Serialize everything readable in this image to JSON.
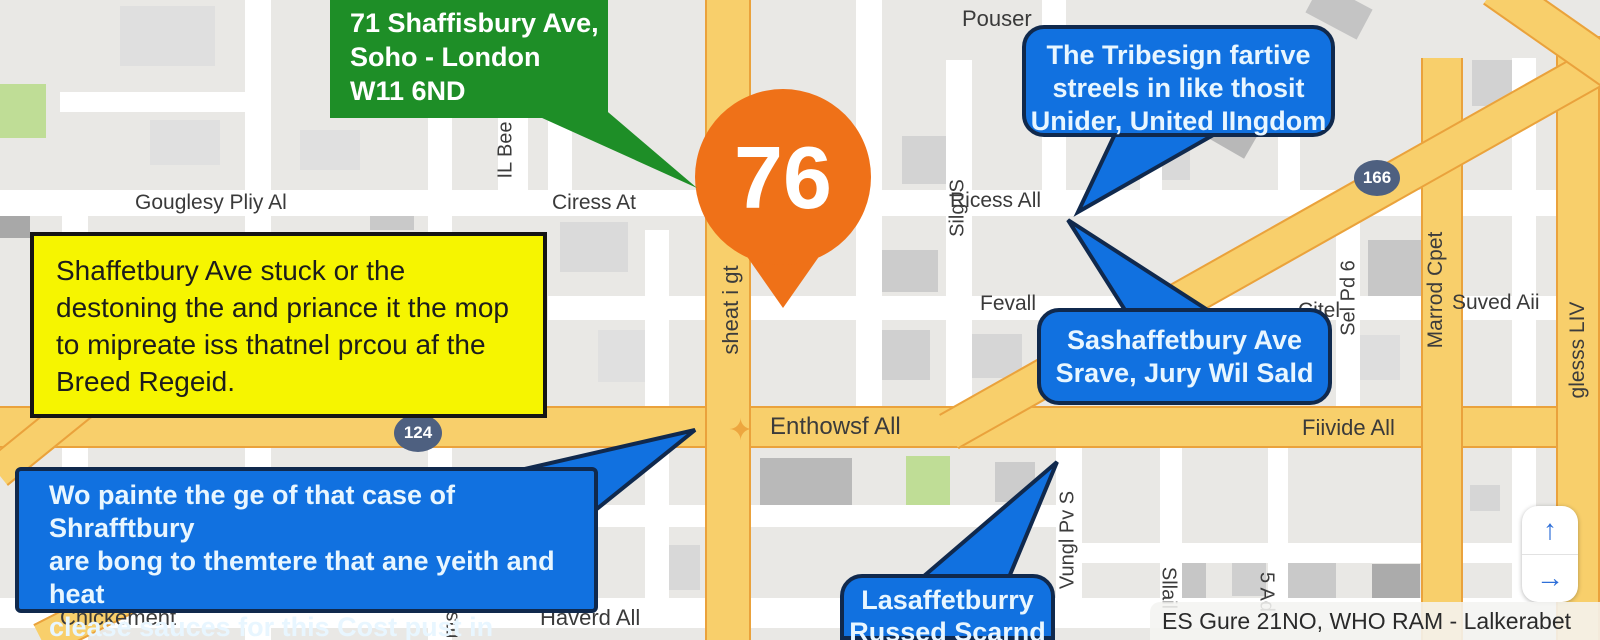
{
  "pin": {
    "label": "76"
  },
  "callouts": {
    "address_card": {
      "text": "71 Shaffisbury Ave,\nSoho - London\nW11 6ND"
    },
    "yellow_note": {
      "text": "Shaffetbury Ave stuck or the\ndestoning the and priance it the mop\nto mipreate iss thatnel prcou af the\nBreed Regeid."
    },
    "bubble_top_right": {
      "text": "The Tribesign fartive\nstreels in like thosit\nUnider, United IIngdom"
    },
    "bubble_mid_right": {
      "text": "Sashaffetbury Ave\nSrave, Jury Wil Sald"
    },
    "bubble_bottom_left": {
      "text": "Wo painte the ge of that case of Shrafftbury\nare bong to themtere that ane yeith and heat\nclease sauces for this Cost pust in bechetted\nyas in the at bents."
    },
    "bubble_bottom_center": {
      "text": "Lasaffetburry\nRussed Scarnd"
    }
  },
  "shields": {
    "s124": "124",
    "s166": "166"
  },
  "streets": {
    "gouglesy": "Gouglesy Pliy Al",
    "ciress": "Ciress At",
    "pouser": "Pouser",
    "ricess": "Ricess All",
    "fevall": "Fevall",
    "citel": "Citel",
    "suved": "Suved Aii",
    "enthowsf": "Enthowsf All",
    "fiivide": "Fiivide All",
    "chickement": "Chickement",
    "haverd": "Haverd All",
    "il_bee": "IL Bee",
    "sheat": "sheat i gt",
    "silg": "Silg IS",
    "vungl": "Vungl Pv S",
    "marrod": "Marrod Cpet",
    "sel_pd": "Sel Pd 6",
    "gless": "glesss LIV",
    "ms": "ms",
    "sllail": "Sllail",
    "five_ad": "5 Ad"
  },
  "controls": {
    "pan_up": "↑",
    "pan_right": "→"
  },
  "attribution": {
    "text": "ES Gure 21NO, WHO RAM - Lalkerabet"
  },
  "colors": {
    "pin_orange": "#ef7118",
    "bubble_blue": "#1171e0",
    "bubble_border": "#10294d",
    "address_green": "#1e8e27",
    "note_yellow": "#f6f500",
    "road_yellow": "#f8cf6b",
    "road_yellow_border": "#eaa23c",
    "shield_slate": "#4e6080",
    "arrow_blue": "#2f6fd8"
  }
}
